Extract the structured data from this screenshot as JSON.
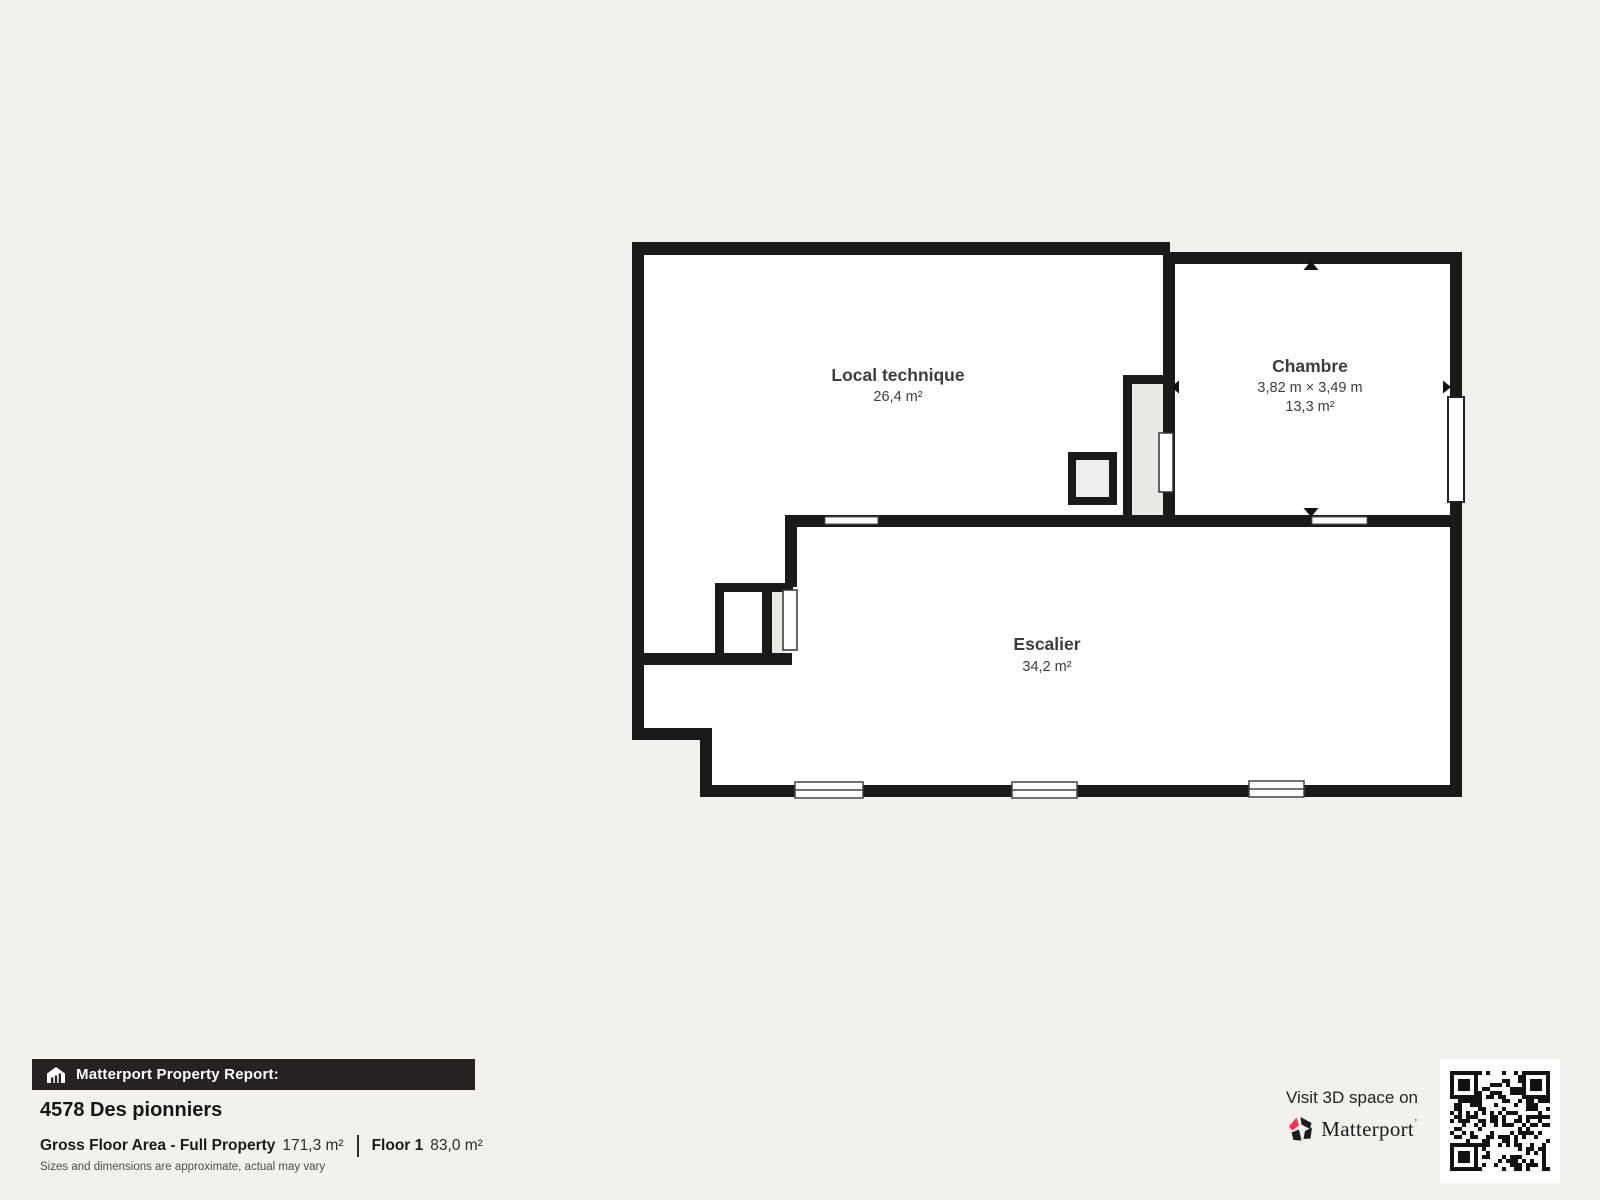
{
  "plan": {
    "rooms": [
      {
        "name": "Local technique",
        "area": "26,4 m²"
      },
      {
        "name": "Chambre",
        "dimensions": "3,82 m × 3,49 m",
        "area": "13,3 m²"
      },
      {
        "name": "Escalier",
        "area": "34,2 m²"
      }
    ]
  },
  "footer": {
    "report_label": "Matterport Property Report:",
    "address": "4578 Des pionniers",
    "gross_floor_label": "Gross Floor Area - Full Property",
    "gross_floor_value": "171,3 m²",
    "floor_label": "Floor 1",
    "floor_value": "83,0 m²",
    "disclaimer": "Sizes and dimensions are approximate, actual may vary",
    "visit_text": "Visit 3D space on",
    "brand_name": "Matterport",
    "brand_mark": "’"
  },
  "colors": {
    "background": "#f2f1ee",
    "wall": "#1a1a1a",
    "room_fill": "#ffffff",
    "alcove_fill": "#ebe9e6",
    "label_text": "#3d3d3d",
    "footer_bar": "#262222",
    "brand_red": "#ff3158"
  }
}
